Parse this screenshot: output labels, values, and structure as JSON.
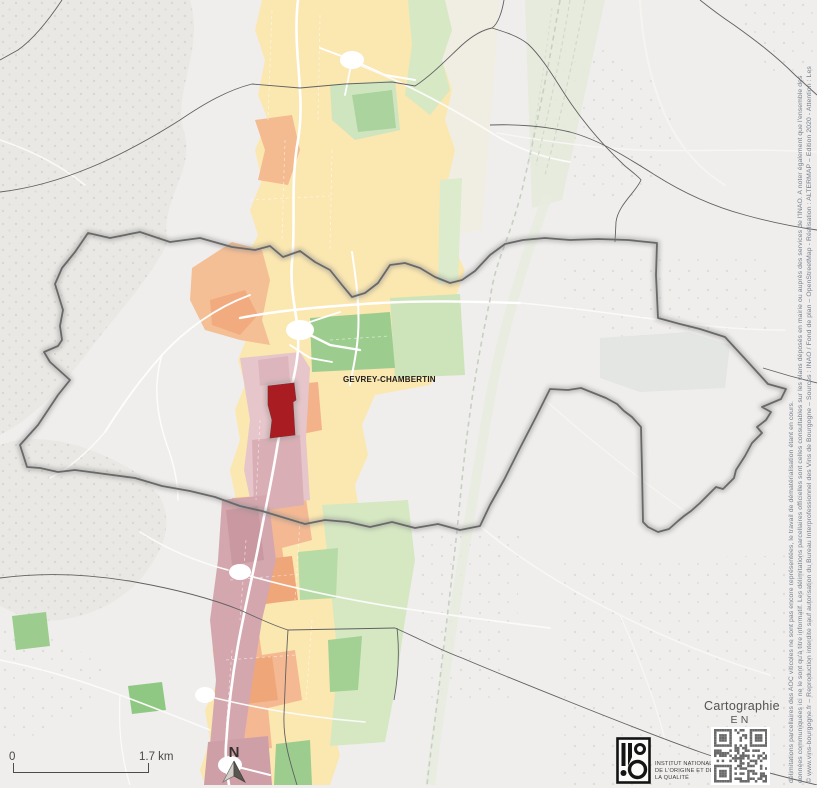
{
  "map": {
    "region_label": "GEVREY-CHAMBERTIN"
  },
  "scale_bar": {
    "start_label": "0",
    "end_label": "1.7 km"
  },
  "north_arrow": {
    "label": "N"
  },
  "branding": {
    "cartography_line1": "Cartographie",
    "cartography_line2": "EN LIGNE",
    "inao_line1": "INSTITUT NATIONAL",
    "inao_line2": "DE L'ORIGINE ET DE",
    "inao_line3": "LA QUALITÉ"
  },
  "copyright": {
    "line1": "© www.vins-bourgogne.fr – Reproduction interdite sauf autorisation du Bureau Interprofessionnel des Vins de Bourgogne – Sources : INAO / Fond de plan – OpenStreetMap - Réalisation : ALTERMAP – Edition 2020 - Attention : Les",
    "line2": "données communiquées ici ne le sont qu'à titre informatif. Les délimitations parcellaires officielles sont celles consultables sur les plans déposés en mairie ou auprès des services de l'INAO. A noter également que l'ensemble des",
    "line3": "délimitations parcellaires des AOC viticoles ne sont pas encore représentées, le travail de dématérialisation étant en cours."
  },
  "colors": {
    "background": "#efeeec",
    "zone_yellow": "#fbe7b0",
    "zone_orange": "#f5bf95",
    "zone_orange_deep": "#efa679",
    "zone_pink": "#e6c6ca",
    "zone_mauve": "#d4a7ae",
    "zone_green": "#9ccd8e",
    "zone_green_light": "#d5e8c2",
    "highlight_parcel_red": "#a81c22",
    "boundary_gray": "#696969",
    "copyright_text": "#76808d"
  }
}
